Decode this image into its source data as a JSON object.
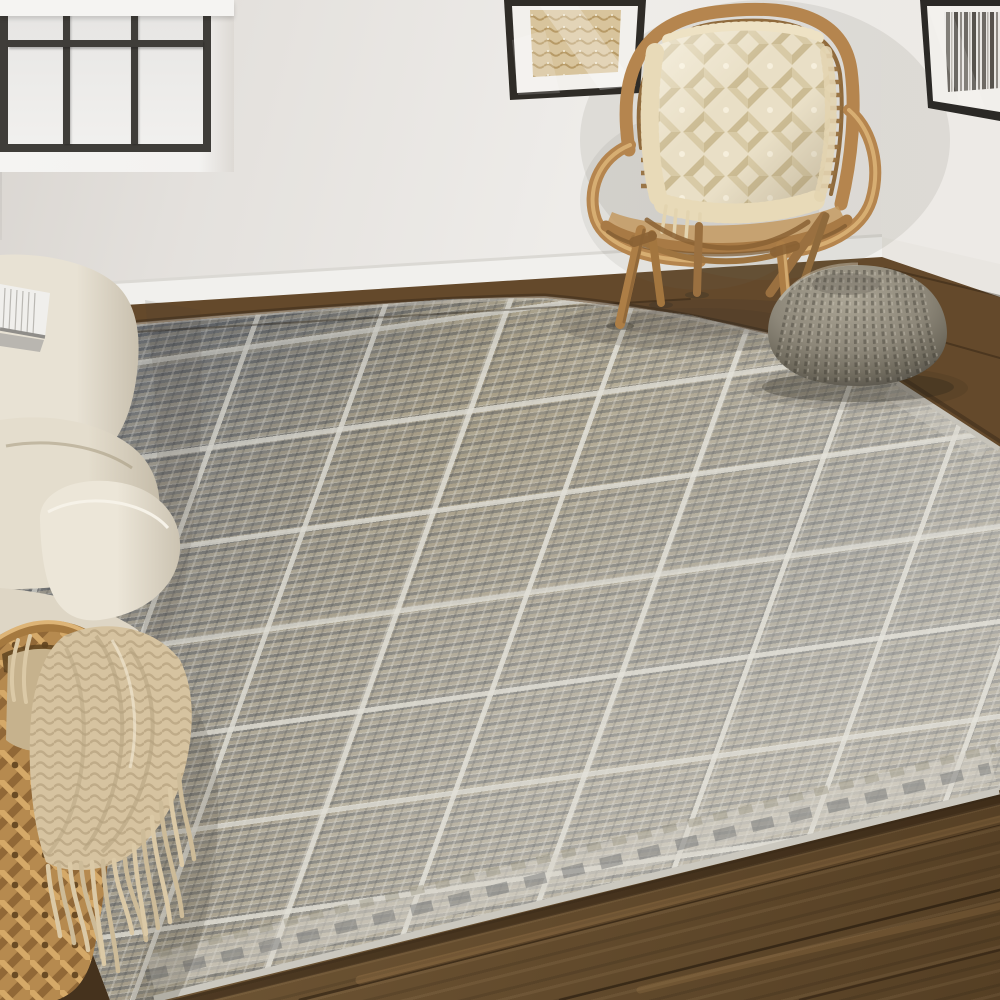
{
  "meta": {
    "title": "Living room scene with geometric area rug",
    "image_type": "interior lifestyle photograph",
    "text_visible": "none"
  },
  "palette": {
    "wall": "#e8e5e1",
    "wall_shadow": "#d9d5d0",
    "window_frame": "#3f3d39",
    "window_glass": "#eceae8",
    "baseboard": "#f1f0ed",
    "floor_wood": "#64492b",
    "floor_wood_dark": "#4e3920",
    "rug_base": "#a5a095",
    "rug_ivory_lines": "#dcdad1",
    "rug_gray_blue": "#7e828a",
    "rug_taupe": "#ab9f84",
    "rattan": "#b5854e",
    "pillow_cream": "#e9dfc6",
    "pouf_gray": "#8a8477",
    "sofa_cream": "#e7e1d3",
    "basket_tan": "#bb8f54",
    "throw_beige": "#d6c3a0",
    "art_left_beige": "#d8c49c",
    "art_right_dark": "#56524c"
  },
  "objects": {
    "wall": {
      "label": "White plaster wall with corner at right"
    },
    "window": {
      "label": "Black-framed window with frosted glass",
      "visible_panes": 6,
      "frame_color": "#3f3d39"
    },
    "wall_art_left": {
      "label": "Framed beige woven-texture abstract art (partially visible)"
    },
    "wall_art_right": {
      "label": "Framed black and white brushstroke art (partially visible)"
    },
    "baseboard": {
      "label": "White baseboard trim"
    },
    "armchair": {
      "label": "Rattan armchair with curved hoop back",
      "material": "rattan",
      "color": "#b5854e"
    },
    "chair_pillow": {
      "label": "Cream tufted diamond-lattice pillow with fringe",
      "color": "#e9dfc6"
    },
    "pouf": {
      "label": "Gray chunky-knit round pouf",
      "color": "#8a8477"
    },
    "sofa": {
      "label": "Cream linen sofa arm and cushions",
      "color": "#e7e1d3"
    },
    "book": {
      "label": "Open book resting on sofa back"
    },
    "basket": {
      "label": "Woven water-hyacinth basket",
      "color": "#bb8f54"
    },
    "throw": {
      "label": "Beige chunky-knit throw blanket with long fringe",
      "color": "#d6c3a0"
    },
    "rug": {
      "label": "Gray, blue and taupe hand-knotted geometric area rug",
      "pattern": "grid of square blocks filled with maze-like geometric motifs, divided by ivory lines",
      "colors": [
        "#7e828a",
        "#ab9f84",
        "#dcdad1",
        "#c9c8c0"
      ]
    },
    "floor": {
      "label": "Dark walnut wood plank floor",
      "color": "#64492b"
    }
  }
}
